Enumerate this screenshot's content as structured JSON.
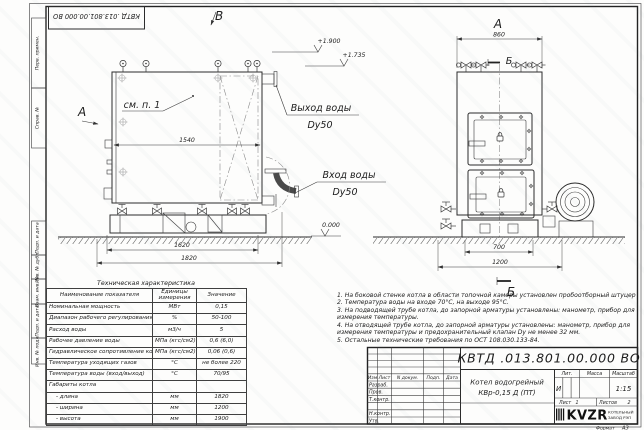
{
  "frame": {
    "doc_number_top": "КВТД .013.801.00.000 ВО",
    "margin_labels": [
      "Перв. примен.",
      "Справ. №",
      "Подп. и дата",
      "Инв. № дубл.",
      "Взам. инв. №",
      "Подп. и дата",
      "Инв. № подл."
    ],
    "format_label": "Формат",
    "format_value": "А3"
  },
  "drawing": {
    "side_view": {
      "letter_a": "А",
      "letter_v": "В",
      "see_note": "см. п. 1",
      "dim_body_width": "1540",
      "dim_base_width": "1620",
      "dim_overall_width": "1820",
      "outlet_line1": "Выход воды",
      "outlet_line2": "Dy50",
      "inlet_line1": "Вход воды",
      "inlet_line2": "Dy50",
      "elev_top": "+1.900",
      "elev_outlet": "+1.735",
      "elev_ground": "0.000"
    },
    "front_view": {
      "letter_a": "А",
      "letter_b_top": "Б",
      "letter_b_bottom": "Б",
      "dim_body_width": "860",
      "dim_base_width": "700",
      "dim_overall_width": "1200"
    }
  },
  "table": {
    "title": "Техническая характеристика",
    "headers": [
      "Наименование показателя",
      "Единицы измерения",
      "Значение"
    ],
    "rows": [
      [
        "Номинальная мощность",
        "МВт",
        "0,15"
      ],
      [
        "Диапазон рабочего регулирования",
        "%",
        "50-100"
      ],
      [
        "Расход воды",
        "м3/ч",
        "5"
      ],
      [
        "Рабочее давление воды",
        "МПа (кгс/см2)",
        "0,6 (6,0)"
      ],
      [
        "Гидравлическое сопротивление котла",
        "МПа (кгс/см2)",
        "0,06 (0,6)"
      ],
      [
        "Температура уходящих газов",
        "°С",
        "не более 220"
      ],
      [
        "Температура воды (вход/выход)",
        "°С",
        "70/95"
      ],
      [
        "Габариты котла",
        "",
        ""
      ],
      [
        "- длина",
        "мм",
        "1820"
      ],
      [
        "- ширина",
        "мм",
        "1200"
      ],
      [
        "- высота",
        "мм",
        "1900"
      ]
    ]
  },
  "notes": [
    "1. На боковой стенке котла в области топочной камеры установлен пробоотборный штуцер",
    "2. Температура воды на входе 70°С, на выходе 95°С.",
    "3. На подводящей трубе котла, до запорной арматуры установлены: манометр, прибор для измерения температуры.",
    "4. На отводящей трубе котла, до запорной арматуры установлены: манометр, прибор для измерения температуры и предохранительный клапан Dу не менее 32 мм.",
    "5. Остальные технические требования по ОСТ 108.030.133-84."
  ],
  "title_block": {
    "doc_number": "КВТД .013.801.00.000  ВО",
    "title_line1": "Котел водогрейный",
    "title_line2": "КВр-0,15 Д (ПТ)",
    "sign_header": [
      "Изм",
      "Лист",
      "N докум.",
      "Подп.",
      "Дата"
    ],
    "sign_rows": [
      "Разраб.",
      "Пров.",
      "Т.контр.",
      "",
      "Н.контр.",
      "Утв."
    ],
    "lit_header": [
      "Лит.",
      "Масса",
      "Масштаб"
    ],
    "lit_value": "И",
    "mass_value": "",
    "scale_value": "1:15",
    "sheet_label": "Лист",
    "sheet_value": "1",
    "sheets_label": "Листов",
    "sheets_value": "2",
    "logo_text": "KVZR",
    "logo_caption1": "КОТЕЛЬНЫЙ",
    "logo_caption2": "ЗАВОД РЭП"
  }
}
